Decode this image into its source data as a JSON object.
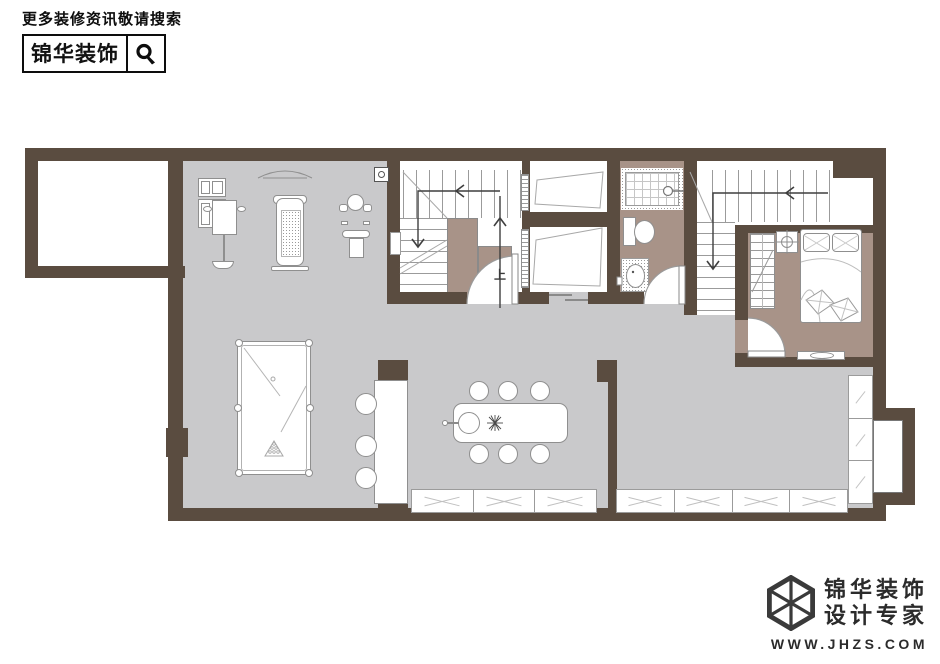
{
  "header": {
    "tagline": "更多装修资讯敬请搜索",
    "brand": "锦华装饰",
    "search_icon": "magnifier-icon"
  },
  "footer": {
    "logo_icon": "cube-wireframe-icon",
    "brand_line1": "锦华装饰",
    "brand_line2": "设计专家",
    "url": "WWW.JHZS.COM"
  },
  "floorplan": {
    "labels": {
      "stairs_up": "上"
    },
    "colors": {
      "wall": "#5a4c40",
      "floor_main": "#c9c9cb",
      "floor_warm": "#a89388",
      "line": "#8f8f8f"
    }
  }
}
